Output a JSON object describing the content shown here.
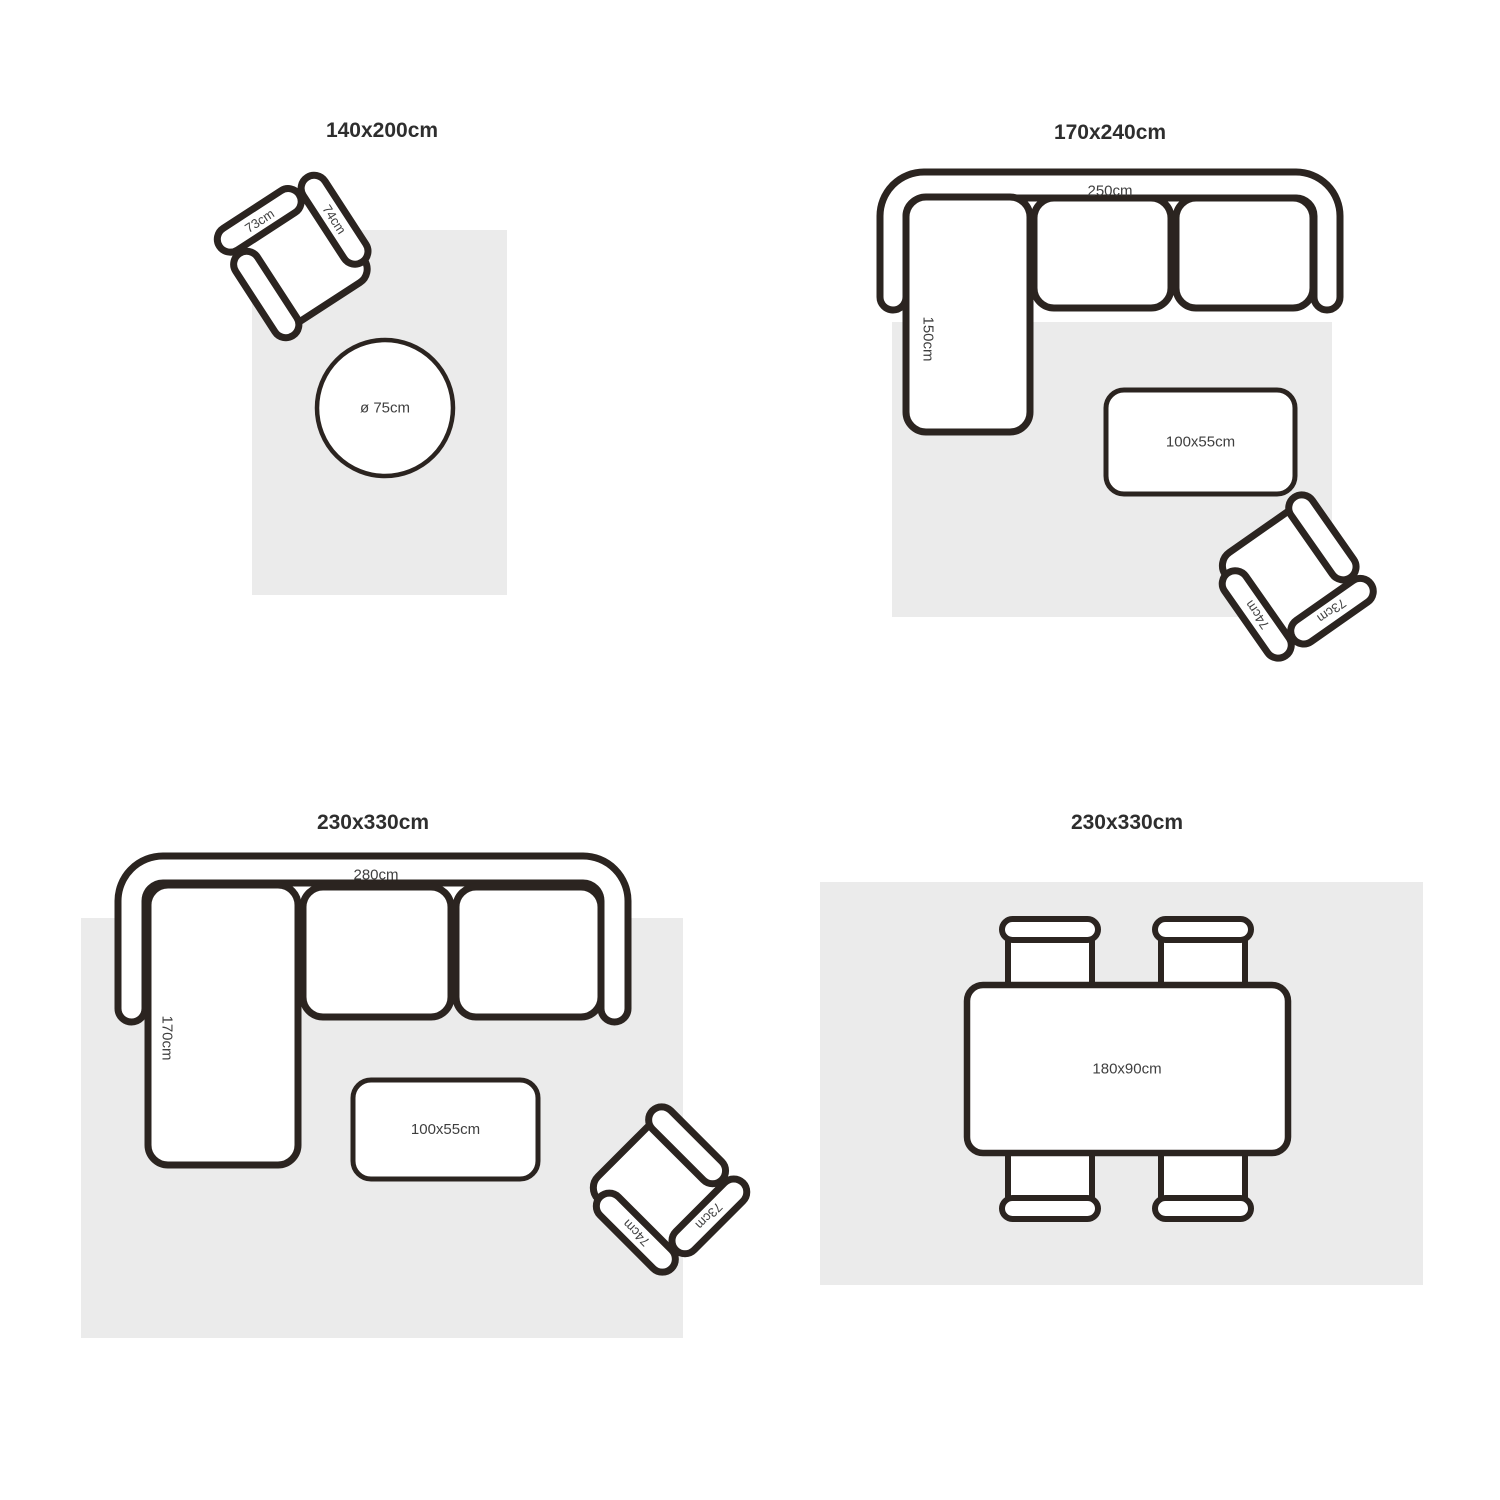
{
  "colors": {
    "outline": "#2b2420",
    "rug_fill": "#ebebeb",
    "title_text": "#2e2e2e",
    "label_text": "#3f3f3f"
  },
  "panels": [
    {
      "title": "140x200cm",
      "armchair": {
        "back_label": "73cm",
        "side_label": "74cm"
      },
      "round_table": {
        "label": "ø 75cm"
      }
    },
    {
      "title": "170x240cm",
      "sofa": {
        "width_label": "250cm",
        "chaise_label": "150cm"
      },
      "coffee_table": {
        "label": "100x55cm"
      },
      "armchair": {
        "back_label": "73cm",
        "side_label": "74cm"
      }
    },
    {
      "title": "230x330cm",
      "sofa": {
        "width_label": "280cm",
        "chaise_label": "170cm"
      },
      "coffee_table": {
        "label": "100x55cm"
      },
      "armchair": {
        "back_label": "73cm",
        "side_label": "74cm"
      }
    },
    {
      "title": "230x330cm",
      "dining_table": {
        "label": "180x90cm"
      }
    }
  ]
}
